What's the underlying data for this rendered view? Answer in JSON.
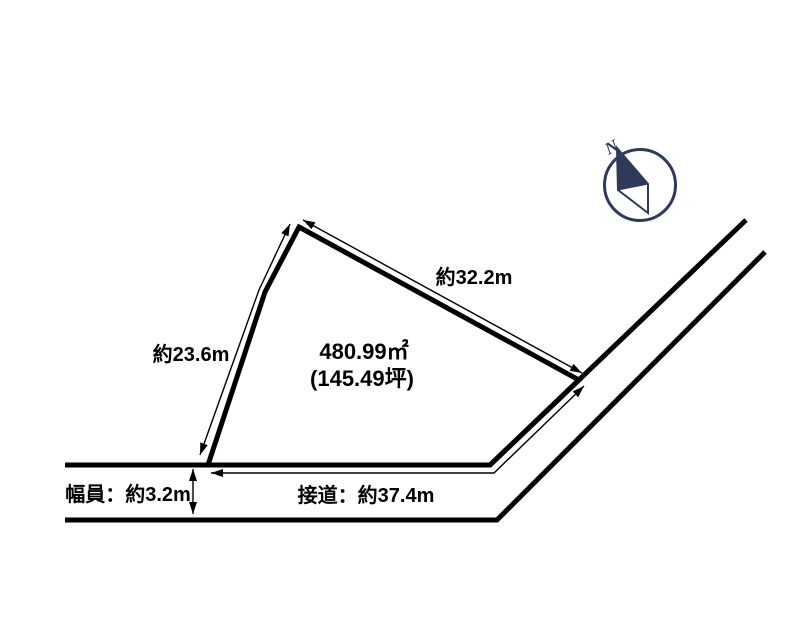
{
  "diagram": {
    "type": "land-plot-survey-drawing",
    "labels": {
      "top_edge": "約32.2m",
      "left_edge": "約23.6m",
      "area_m2": "480.99㎡",
      "area_tsubo": "(145.49坪)",
      "road_frontage": "接道：約37.4m",
      "road_width": "幅員：約3.2m",
      "compass_north": "N"
    },
    "measurements": {
      "area_m2": 480.99,
      "area_tsubo": 145.49,
      "top_edge_m": 32.2,
      "left_edge_m": 23.6,
      "road_frontage_m": 37.4,
      "road_width_m": 3.2
    },
    "colors": {
      "line": "#000000",
      "text": "#000000",
      "compass": "#2e3a59",
      "background": "#ffffff"
    }
  }
}
